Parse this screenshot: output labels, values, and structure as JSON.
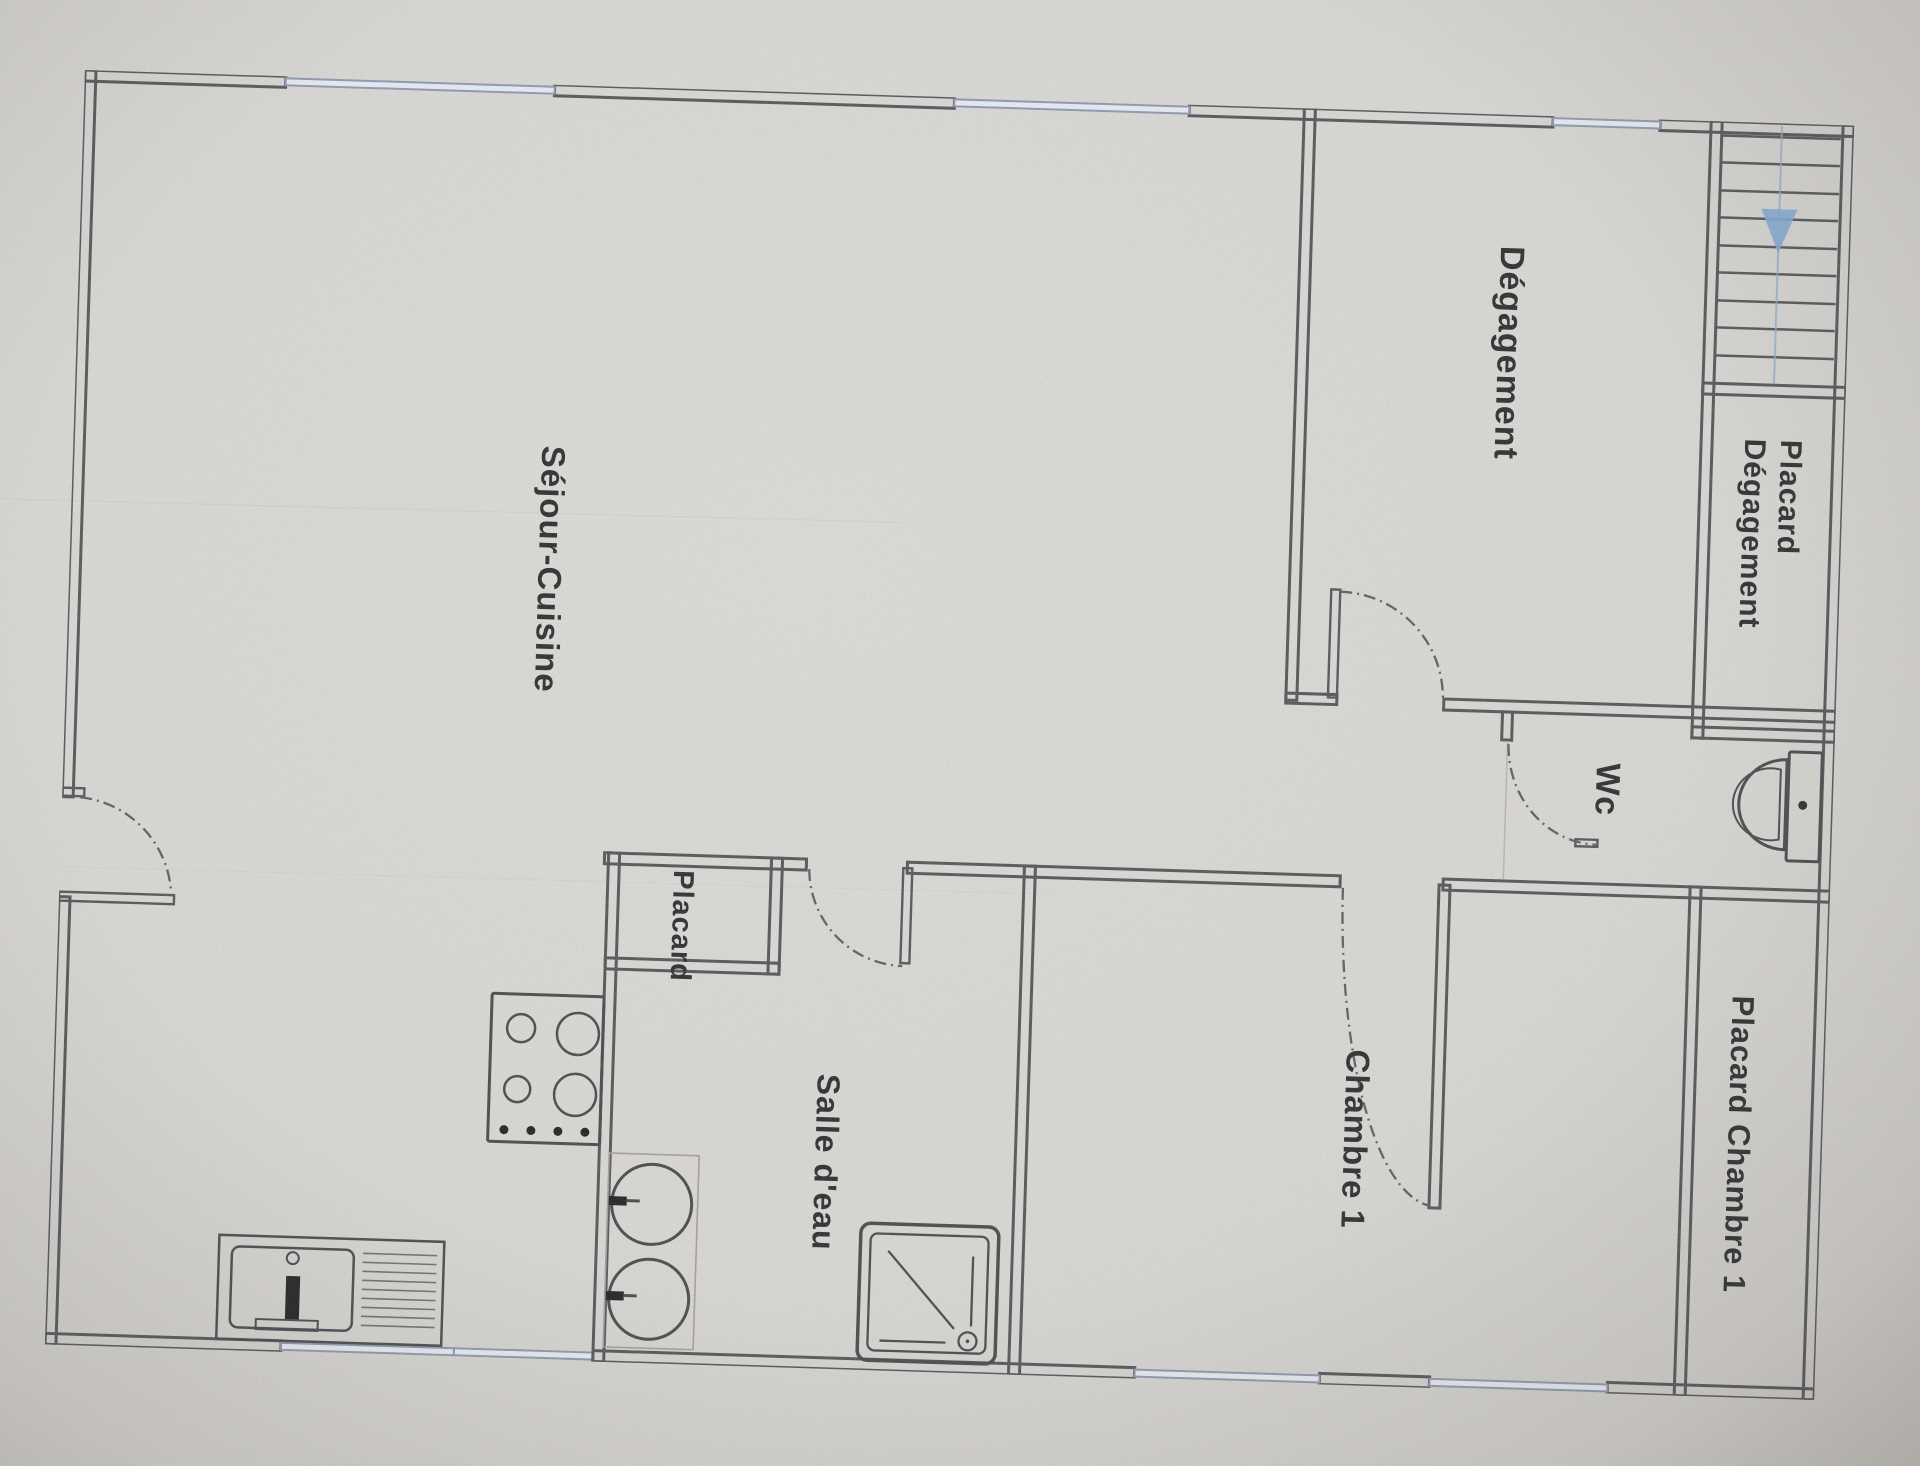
{
  "document": {
    "type_note": "photographed architectural floor plan, labels rotated 90 degrees clockwise",
    "language": "French"
  },
  "labels": {
    "sejour": "Séjour-Cuisine",
    "degagement": "Dégagement",
    "placard_degagement_line1": "Placard",
    "placard_degagement_line2": "Dégagement",
    "placard_kitchen": "Placard",
    "salle_eau": "Salle d'eau",
    "wc": "Wc",
    "chambre1": "Chambre 1",
    "placard_chambre1": "Placard Chambre 1"
  },
  "fixtures": [
    "staircase-with-down-arrow",
    "kitchen-sink-unit",
    "cooktop-4-burners",
    "washing-machines-stacked",
    "shower-tray",
    "toilet"
  ],
  "doors": {
    "count_swing_arcs": 5,
    "style": "dash-dot quarter arcs"
  },
  "windows": {
    "top_wall_count": 3,
    "bottom_wall_count": 4
  },
  "colors": {
    "paper": "#d8d6d2",
    "wall_line": "#55555a",
    "window_line": "#8e97ad",
    "window_fill": "#e7eaf1",
    "stair_arrow_blue": "#82a8d2",
    "label_text": "#2e2e30"
  }
}
